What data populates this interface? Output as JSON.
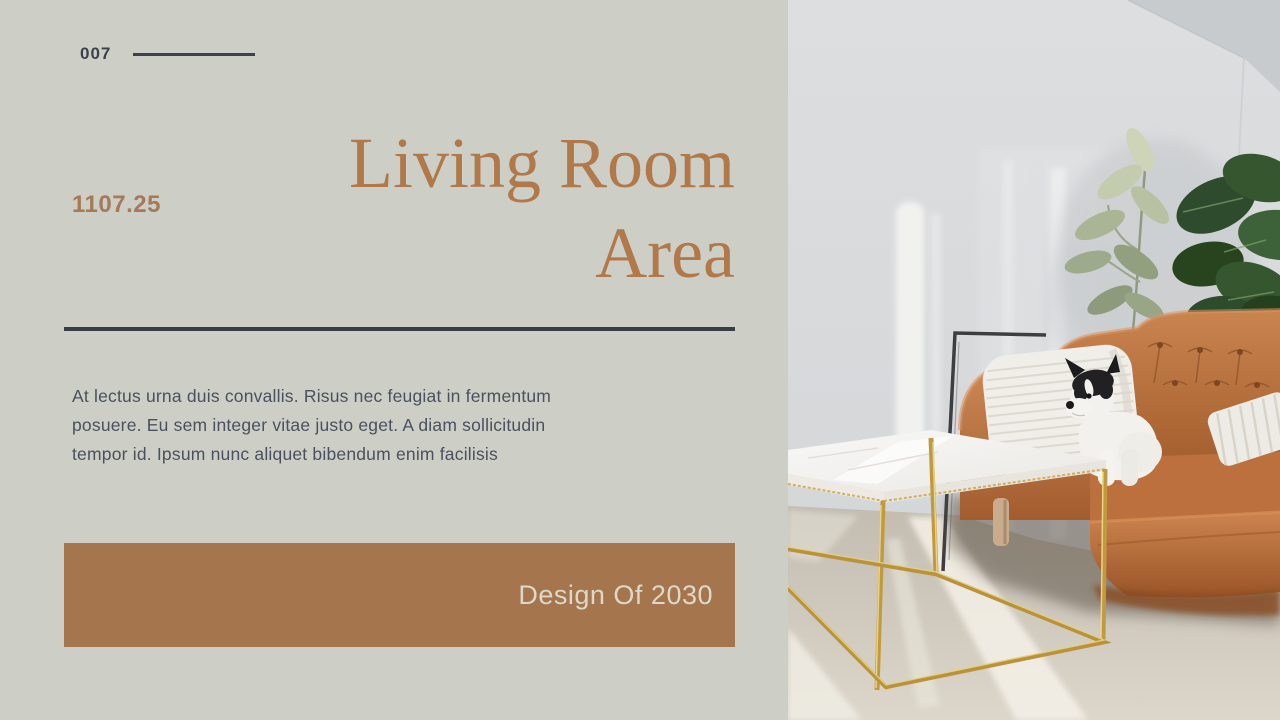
{
  "slide": {
    "page_number": "007",
    "reference_number": "1107.25",
    "title_line1": "Living Room",
    "title_line2": "Area",
    "body_text": "At lectus urna duis convallis. Risus nec feugiat in fermentum posuere. Eu sem integer vitae justo eget. A diam sollicitudin tempor id. Ipsum nunc aliquet bibendum enim facilisis",
    "banner_label": "Design Of 2030"
  },
  "photo": {
    "alt": "Living room with tan leather sofa, small black and white dog on a white pillow, green plants, leaning frame and a white marble coffee table with gold legs"
  },
  "colors": {
    "panel_background": "#cdcfc7",
    "title_brown": "#b1794a",
    "number_brown": "#a47a58",
    "dark_line": "#383d48",
    "body_text": "#4a505e",
    "banner_background": "#a5764d",
    "banner_text": "#ddd8c9"
  }
}
